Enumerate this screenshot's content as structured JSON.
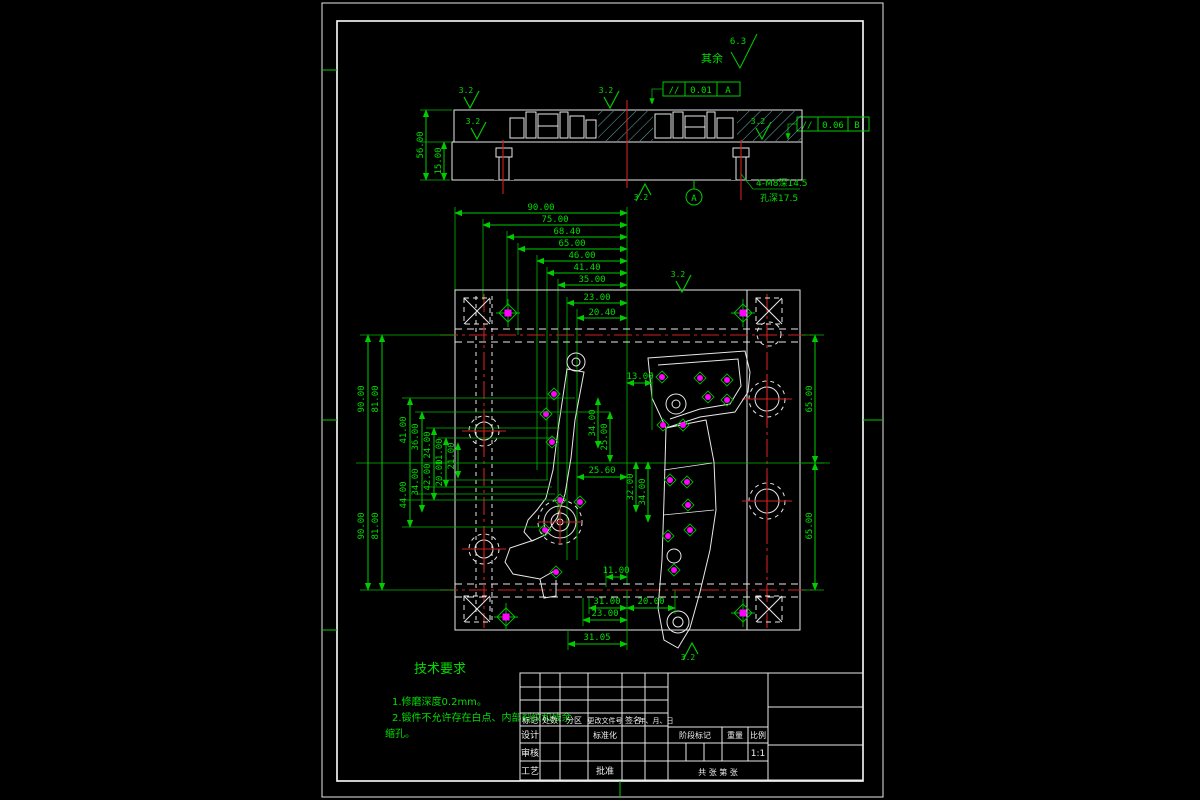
{
  "colors": {
    "background": "#000000",
    "line_green": "#00cc00",
    "line_white": "#e8e8e8",
    "hatch_cyan": "#79d8d8",
    "centerline_red": "#d01f1f",
    "point_magenta": "#ff00ff"
  },
  "annotations": {
    "surface_default_label": "其余",
    "surface_default_value": "6.3",
    "roughness": "3.2",
    "parallelism_top": {
      "sym": "//",
      "tol": "0.01",
      "datum": "A"
    },
    "parallelism_right": {
      "sym": "//",
      "tol": "0.06",
      "datum": "B"
    },
    "thread_note_line1": "4-M8深14.5",
    "thread_note_line2": "孔深17.5",
    "datum_label": "A"
  },
  "section_dims": {
    "height_total": "56.00",
    "height_lower": "15.00"
  },
  "top_chain": [
    "90.00",
    "75.00",
    "68.40",
    "65.00",
    "46.00",
    "41.40",
    "35.00",
    "23.00",
    "20.40"
  ],
  "left_dims_top": [
    "90.00",
    "81.00",
    "41.00",
    "36.00",
    "24.00",
    "11.00",
    "21.00"
  ],
  "left_dims_bottom": [
    "90.00",
    "81.00",
    "44.00",
    "34.00",
    "42.00",
    "20.00"
  ],
  "plan_dims": {
    "a": "13.00",
    "b": "34.00",
    "c": "25.00",
    "d": "25.60",
    "e": "32.00",
    "f": "34.00",
    "g": "11.00",
    "h": "65.00",
    "i": "65.00"
  },
  "bottom_chain": {
    "a": "31.00",
    "b": "20.00",
    "c": "23.00",
    "d": "31.05"
  },
  "notes": {
    "title": "技术要求",
    "line1": "1.修磨深度0.2mm。",
    "line2": "2.锻件不允许存在白点、内部裂纹和残余",
    "line3": "缩孔。"
  },
  "title_block": {
    "headers": [
      "标记",
      "处数",
      "分区",
      "更改文件号",
      "签名",
      "年、月、日"
    ],
    "row_design": "设计",
    "row_standard": "标准化",
    "row_check": "审核",
    "row_process": "工艺",
    "row_approve": "批准",
    "stage": "阶段标记",
    "weight": "重量",
    "scale_label": "比例",
    "scale_value": "1:1",
    "sheet": "共  张 第  张"
  }
}
